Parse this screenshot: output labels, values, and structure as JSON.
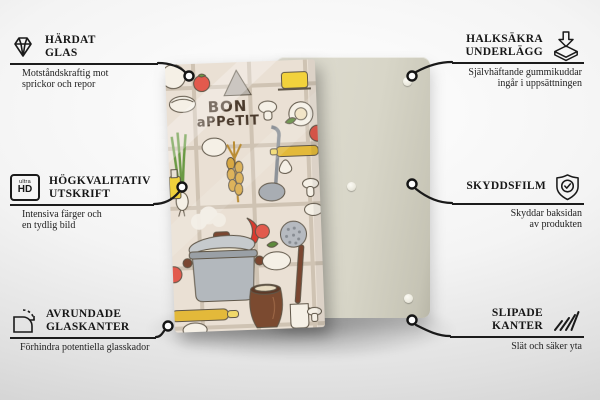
{
  "product": {
    "front_design": {
      "text_line1": "BON",
      "text_line2": "aPPeTIT",
      "theme": "kitchen-cooking-illustration"
    },
    "back_panel": {
      "rubber_pads_visible": 3
    }
  },
  "colors": {
    "text": "#1a1a1a",
    "connector": "#1a1a1a",
    "front_panel_bg": "#eae0d4",
    "back_panel_bg": "#d8d6c8",
    "tomato_red": "#e25a4d",
    "wood_yellow": "#e3b93a",
    "pot_grey": "#b6bac0",
    "clay_brown": "#7b4a30"
  },
  "features": {
    "left": [
      {
        "icon": "diamond-icon",
        "title_lines": [
          "HÄRDAT",
          "GLAS"
        ],
        "desc_lines": [
          "Motståndskraftig mot",
          "sprickor och repor"
        ]
      },
      {
        "icon": "ultra-hd-icon",
        "icon_labels": {
          "top": "ultra",
          "main": "HD"
        },
        "title_lines": [
          "HÖGKVALITATIV",
          "UTSKRIFT"
        ],
        "desc_lines": [
          "Intensiva färger och",
          "en tydlig bild"
        ]
      },
      {
        "icon": "rounded-corner-icon",
        "title_lines": [
          "AVRUNDADE",
          "GLASKANTER"
        ],
        "desc_lines": [
          "Förhindra potentiella glasskador"
        ]
      }
    ],
    "right": [
      {
        "icon": "non-slip-pad-icon",
        "title_lines": [
          "HALKSÄKRA",
          "UNDERLÄGG"
        ],
        "desc_lines": [
          "Självhäftande gummikuddar",
          "ingår i uppsättningen"
        ]
      },
      {
        "icon": "shield-check-icon",
        "title_lines": [
          "SKYDDSFILM"
        ],
        "desc_lines": [
          "Skyddar baksidan",
          "av produkten"
        ]
      },
      {
        "icon": "ground-edge-icon",
        "title_lines": [
          "SLIPADE",
          "KANTER"
        ],
        "desc_lines": [
          "Slät och säker yta"
        ]
      }
    ]
  }
}
